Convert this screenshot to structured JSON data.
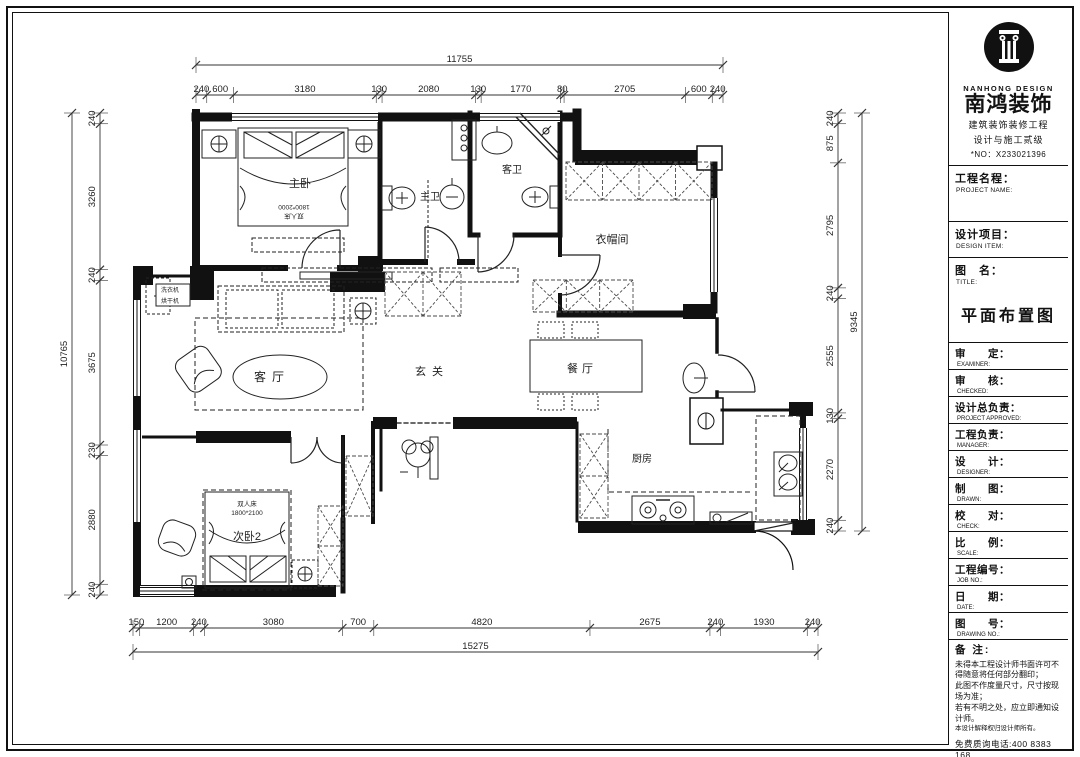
{
  "colors": {
    "ink": "#111111",
    "dash": "#555555",
    "hatch": "#4a4a4a"
  },
  "dimensions": {
    "top": {
      "total": "11755",
      "segments": [
        "240",
        "600",
        "3180",
        "130",
        "2080",
        "130",
        "1770",
        "80",
        "2705",
        "600",
        "240"
      ]
    },
    "bottom": {
      "total": "15275",
      "segments": [
        "150",
        "1200",
        "240",
        "3080",
        "700",
        "4820",
        "2675",
        "240",
        "1930",
        "240"
      ]
    },
    "left": {
      "total": "10765",
      "segments": [
        "240",
        "3260",
        "240",
        "3675",
        "230",
        "2880",
        "240"
      ]
    },
    "right": {
      "total": "9345",
      "segments": [
        "240",
        "875",
        "2795",
        "240",
        "2555",
        "130",
        "2270",
        "240"
      ]
    }
  },
  "plan": {
    "rooms": [
      {
        "t": "主卧",
        "x": 300,
        "y": 187,
        "s": 11
      },
      {
        "t": "主卫",
        "x": 430,
        "y": 200,
        "s": 10
      },
      {
        "t": "客卫",
        "x": 512,
        "y": 173,
        "s": 10
      },
      {
        "t": "衣帽间",
        "x": 612,
        "y": 243,
        "s": 11
      },
      {
        "t": "客厅",
        "x": 272,
        "y": 381,
        "s": 12,
        "ls": 6
      },
      {
        "t": "玄关",
        "x": 432,
        "y": 375,
        "s": 11,
        "ls": 6
      },
      {
        "t": "餐厅",
        "x": 582,
        "y": 372,
        "s": 11,
        "ls": 4
      },
      {
        "t": "厨房",
        "x": 642,
        "y": 462,
        "s": 10
      },
      {
        "t": "次卧2",
        "x": 247,
        "y": 540,
        "s": 11
      }
    ],
    "annotations": [
      {
        "t": "1800*2000",
        "x": 294,
        "y": 205,
        "s": 6.5,
        "r": 180
      },
      {
        "t": "双人床",
        "x": 294,
        "y": 214,
        "s": 6.5,
        "r": 180
      },
      {
        "t": "双人床",
        "x": 247,
        "y": 506,
        "s": 6.5
      },
      {
        "t": "1800*2100",
        "x": 247,
        "y": 515,
        "s": 6.5
      },
      {
        "t": "洗衣机",
        "x": 170,
        "y": 292,
        "s": 6
      },
      {
        "t": "烘干机",
        "x": 170,
        "y": 303,
        "s": 6
      }
    ]
  },
  "titleblock": {
    "logo_en": "NANHONG DESIGN",
    "logo_cn": "南鸿装饰",
    "cert_line1": "建筑装饰装修工程",
    "cert_line2": "设计与施工贰级",
    "cert_no": "*NO：X233021396",
    "project_name": {
      "cn": "工程名程：",
      "en": "PROJECT NAME:"
    },
    "design_item": {
      "cn": "设计项目：",
      "en": "DESIGN ITEM:"
    },
    "drawing_name": {
      "cn": "图　名：",
      "en": "TITLE:"
    },
    "drawing_title": "平面布置图",
    "rows": [
      {
        "cn": "审　　定：",
        "en": "EXAMINER:"
      },
      {
        "cn": "审　　核：",
        "en": "CHECKED:"
      },
      {
        "cn": "设计总负责：",
        "en": "PROJECT APPROVED:"
      },
      {
        "cn": "工程负责：",
        "en": "MANAGER:"
      },
      {
        "cn": "设　　计：",
        "en": "DESIGNER:"
      },
      {
        "cn": "制　　图：",
        "en": "DRAWN:"
      },
      {
        "cn": "校　　对：",
        "en": "CHECK:"
      },
      {
        "cn": "比　　例：",
        "en": "SCALE:"
      },
      {
        "cn": "工程编号：",
        "en": "JOB NO.:"
      },
      {
        "cn": "日　　期：",
        "en": "DATE:"
      },
      {
        "cn": "图　　号：",
        "en": "DRAWING NO.:"
      }
    ],
    "notes_title": "备 注:",
    "notes": [
      "未得本工程设计师书面许可不得随意将任何部分翻印；",
      "此图不作度量尺寸，尺寸按现场为准；",
      "若有不明之处，应立即通知设计师。",
      "本设计解释权归设计师所有。"
    ],
    "hotline": "免费质询电话:400 8383 168"
  }
}
